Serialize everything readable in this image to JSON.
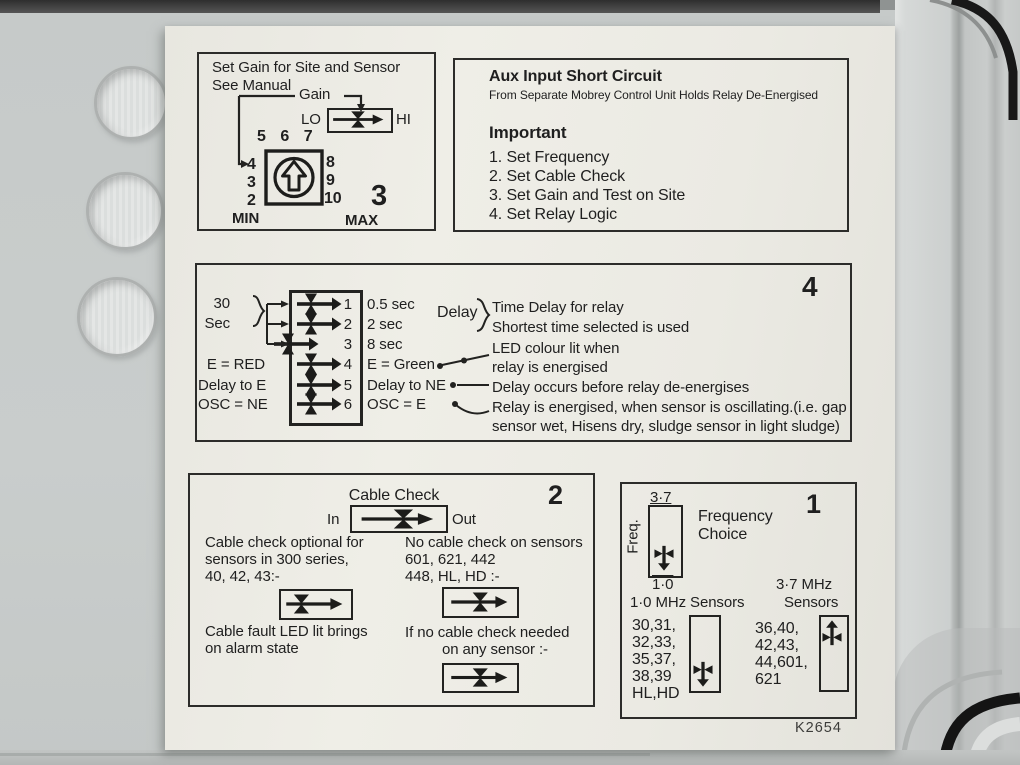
{
  "colors": {
    "paper": "#edece5",
    "ink": "#1f1f1f",
    "plastic": "#c8cccb",
    "dark_edge": "#3a3a3a"
  },
  "footer_code": "K2654",
  "gain": {
    "number": "3",
    "line1": "Set Gain for Site and Sensor",
    "line2": "See Manual",
    "gain": "Gain",
    "lo": "LO",
    "hi": "HI",
    "dial_top": "5 6 7",
    "dial_left": [
      "4",
      "3",
      "2"
    ],
    "dial_right": [
      "8",
      "9",
      "10"
    ],
    "min": "MIN",
    "max": "MAX"
  },
  "aux": {
    "title": "Aux Input Short Circuit",
    "subtitle": "From Separate Mobrey Control Unit Holds Relay De-Energised",
    "heading": "Important",
    "steps": [
      "1. Set Frequency",
      "2. Set Cable Check",
      "3. Set Gain and Test on Site",
      "4. Set Relay Logic"
    ]
  },
  "relay": {
    "number": "4",
    "group_label": [
      "30",
      "Sec"
    ],
    "rows": [
      {
        "num": "1",
        "right": "0.5 sec"
      },
      {
        "num": "2",
        "right": "2 sec"
      },
      {
        "num": "3",
        "right": "8 sec"
      },
      {
        "num": "4",
        "right": "E = Green",
        "left": "E = RED"
      },
      {
        "num": "5",
        "right": "Delay to NE",
        "left": "Delay to E"
      },
      {
        "num": "6",
        "right": "OSC = E",
        "left": "OSC = NE"
      }
    ],
    "delay_label": "Delay",
    "notes": {
      "delay1": "Time Delay for relay",
      "delay2": "Shortest time selected is used",
      "led1": "LED colour lit when",
      "led2": "relay is energised",
      "ne": "Delay occurs before relay de-energises",
      "osc1": "Relay is energised, when sensor is oscillating.(i.e. gap",
      "osc2": "sensor wet, Hisens dry, sludge sensor in light sludge)"
    }
  },
  "cable": {
    "number": "2",
    "title": "Cable Check",
    "in": "In",
    "out": "Out",
    "optional": [
      "Cable check optional for",
      "sensors in 300 series,",
      "40, 42, 43:-"
    ],
    "none": [
      "No cable check on sensors",
      "601, 621, 442",
      "448, HL, HD :-"
    ],
    "fault": [
      "Cable fault LED lit brings",
      "on alarm state"
    ],
    "no_check": [
      "If no cable check needed",
      "on any sensor :-"
    ]
  },
  "freq": {
    "number": "1",
    "label": "Freq.",
    "top": "3·7",
    "bottom": "1·0",
    "choice": [
      "Frequency",
      "Choice"
    ],
    "mhz10_title": "1·0 MHz Sensors",
    "mhz10_sensors": [
      "30,31,",
      "32,33,",
      "35,37,",
      "38,39",
      "HL,HD"
    ],
    "mhz37_title": [
      "3·7 MHz",
      "Sensors"
    ],
    "mhz37_sensors": [
      "36,40,",
      "42,43,",
      "44,601,",
      "621"
    ]
  }
}
